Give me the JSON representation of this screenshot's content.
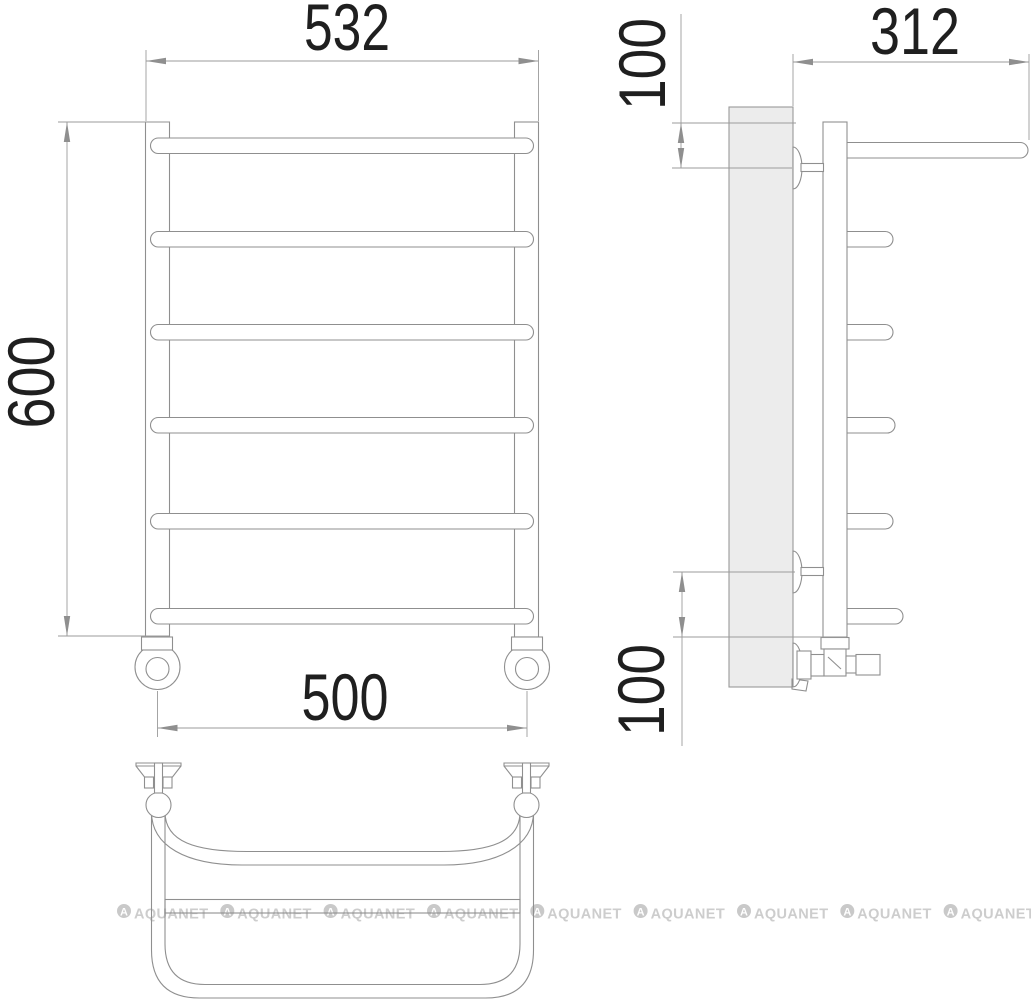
{
  "watermark": {
    "text": "AQUANET",
    "logo_letter": "A"
  },
  "views": {
    "front": {
      "dims": {
        "width_top": "532",
        "height": "600",
        "width_bottom": "500"
      }
    },
    "side": {
      "dims": {
        "depth": "312",
        "top_offset": "100",
        "bottom_offset": "100"
      }
    }
  },
  "colors": {
    "line": "#8f8f8f",
    "dimension_line": "#9b9b9b",
    "dimension_text": "#1f1f1f",
    "wall_plate_fill": "#ececec",
    "watermark": "#cdcdcd",
    "background": "#ffffff"
  }
}
